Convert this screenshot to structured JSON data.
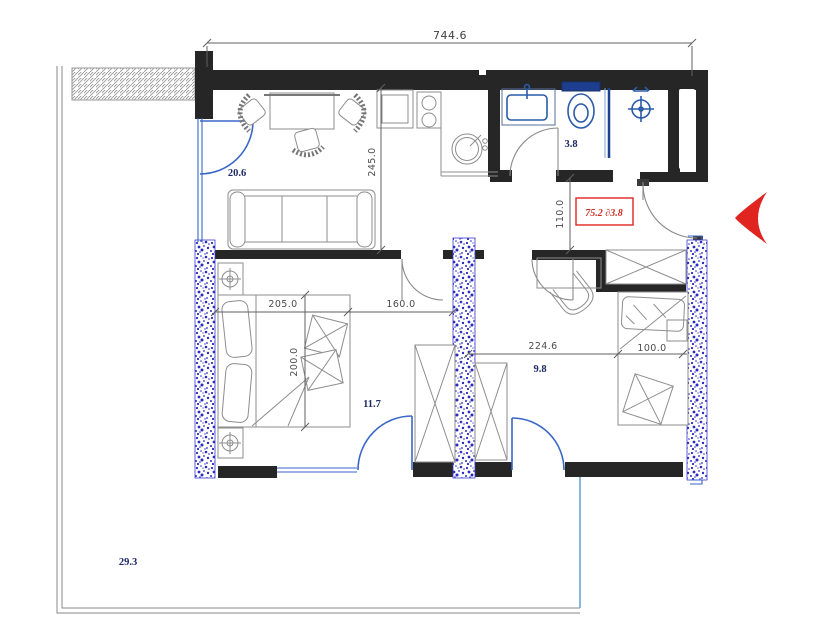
{
  "dimensions": {
    "overall_width": "744.6",
    "living_depth": "245.0",
    "entry_recess": "110.0",
    "bedroom1_width": "205.0",
    "passage_width": "160.0",
    "bedroom1_depth": "200.0",
    "bedroom2_width": "224.6",
    "bed_width": "100.0"
  },
  "room_areas": {
    "living_kitchen": "20.6",
    "bathroom": "3.8",
    "bedroom1": "11.7",
    "bedroom2": "9.8",
    "terrace": "29.3"
  },
  "stamp": {
    "label": "75.2 ∂3.8"
  },
  "colors": {
    "wall": "#262626",
    "fixture_blue": "#2a5aa8",
    "opening_blue": "#3a66c8",
    "column_speckle": "#2b2bbf",
    "furniture_gray": "#8e8e8e",
    "dimension_gray": "#4d4d4d",
    "room_label_navy": "#1d2a66",
    "accent_red": "#e02520",
    "railing_blue": "#7ab0d8",
    "terrace_line": "#8a8a8a"
  }
}
